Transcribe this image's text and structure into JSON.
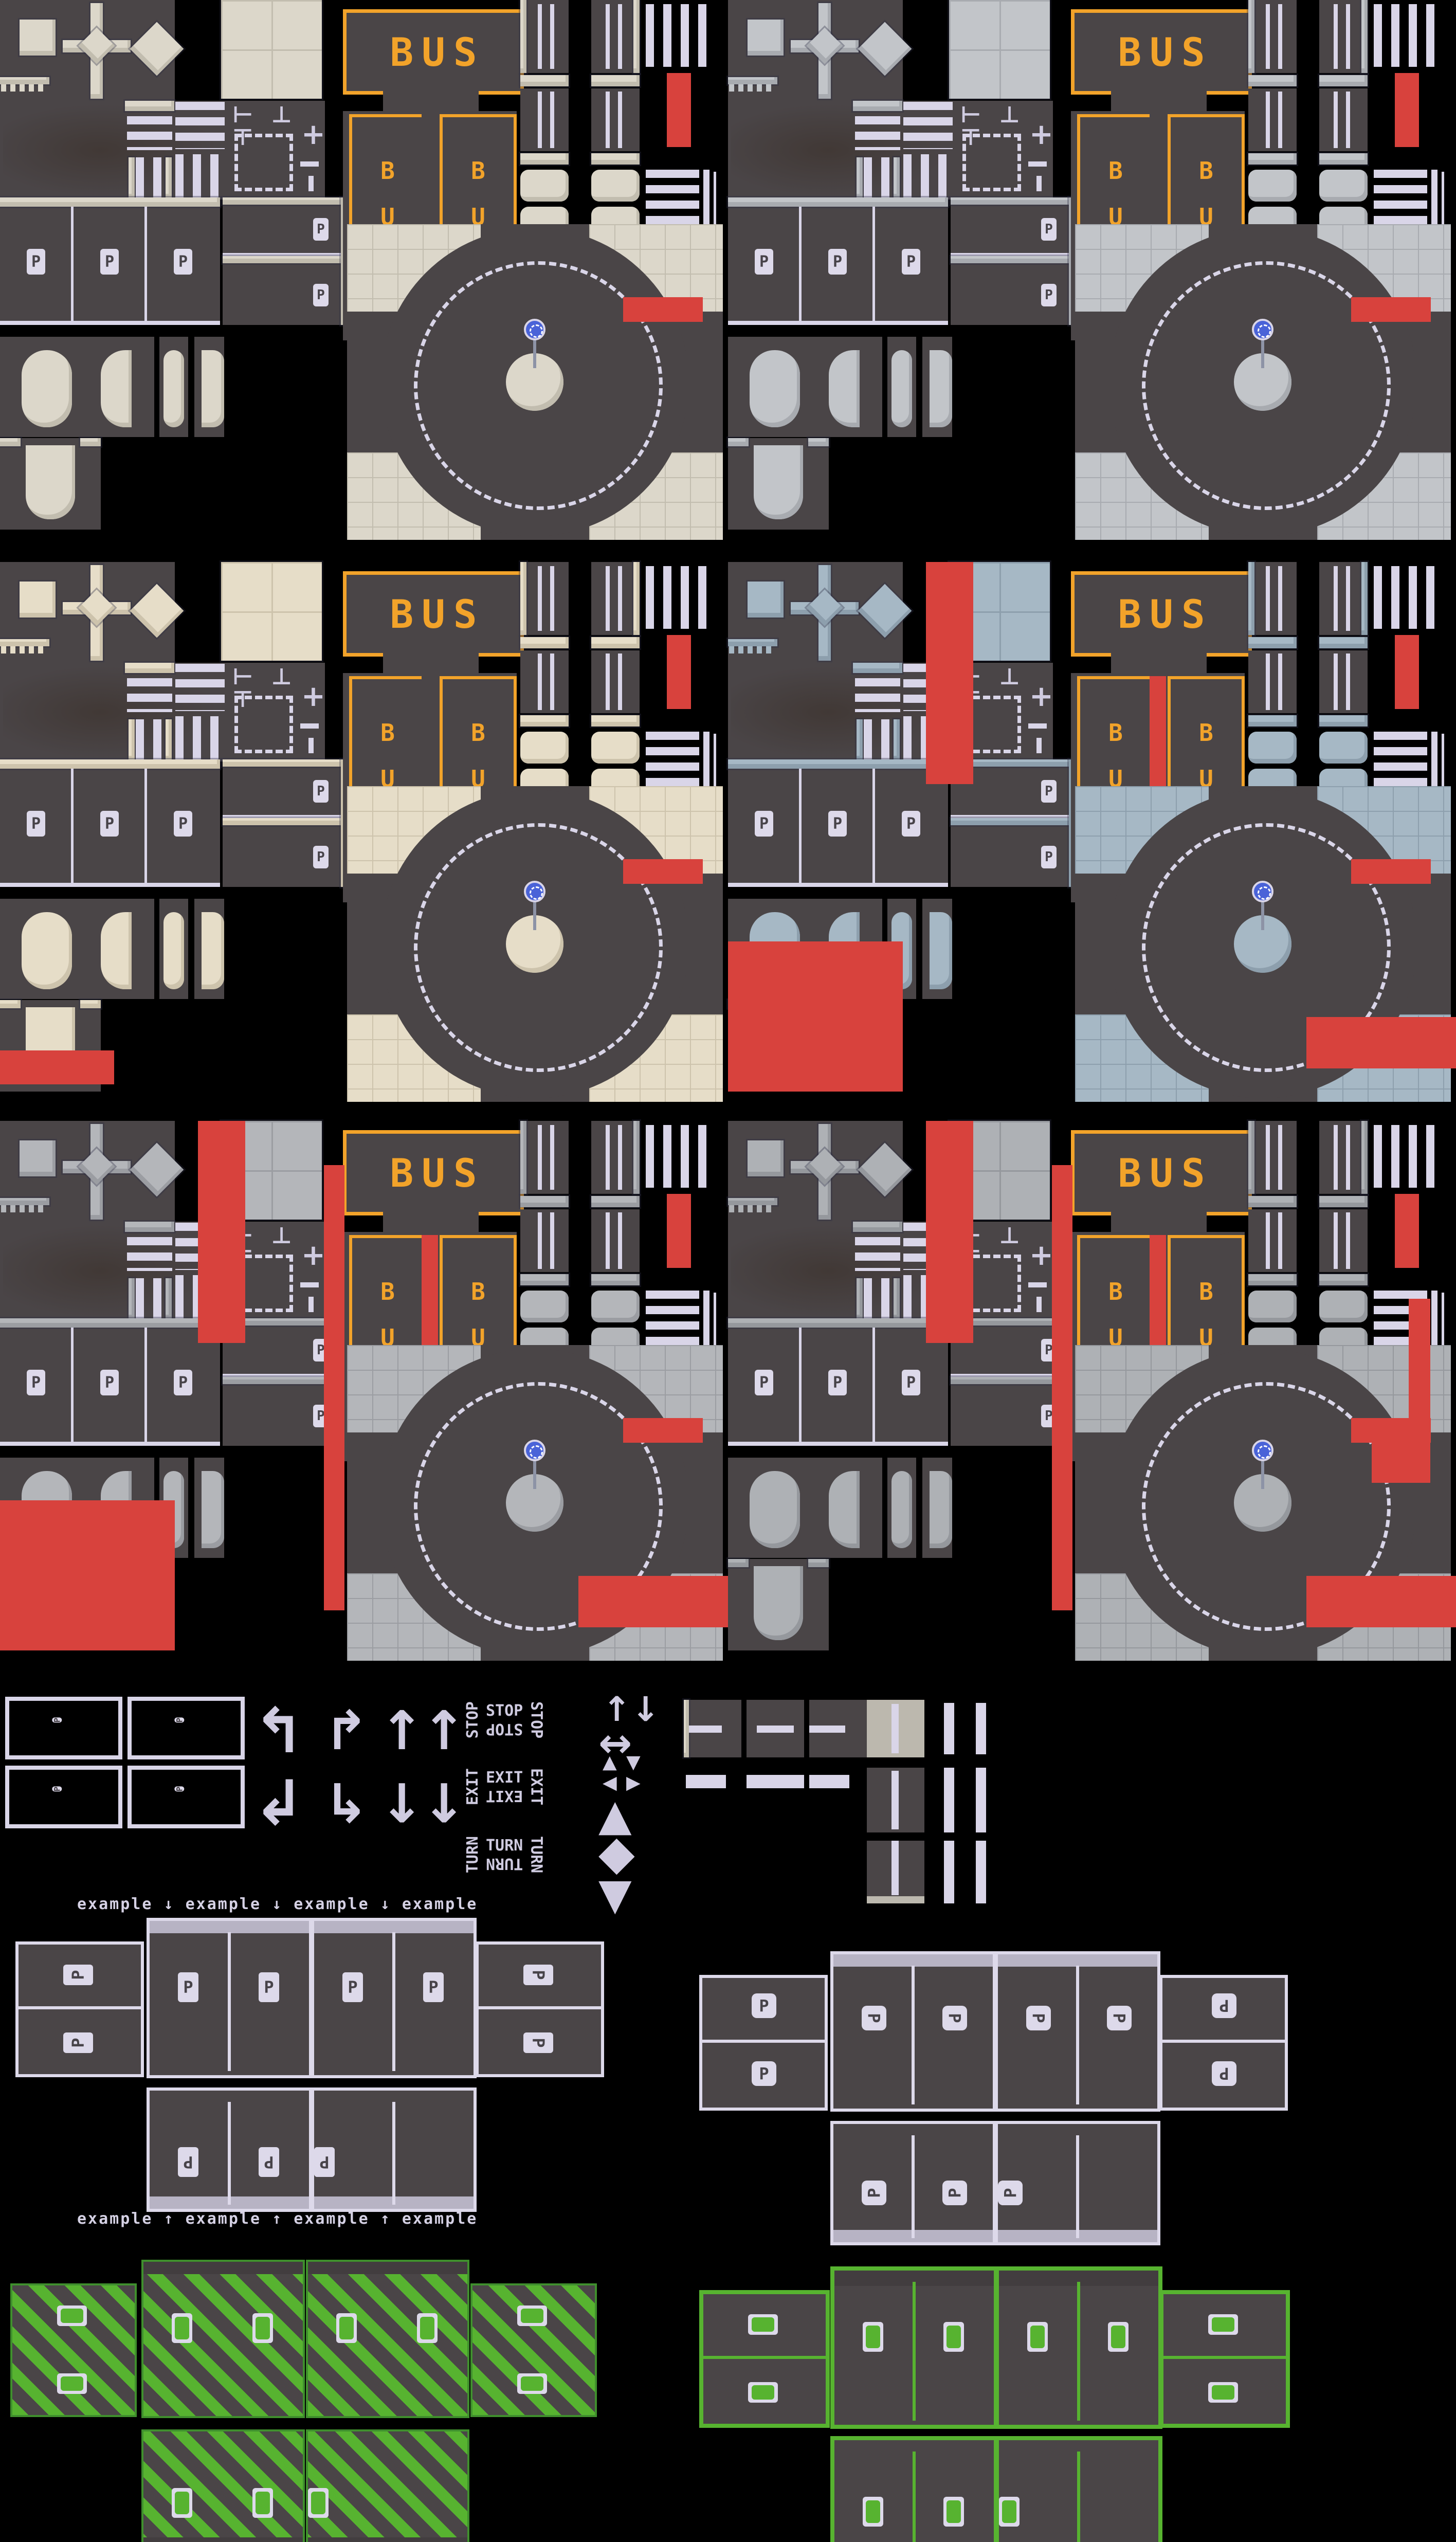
{
  "labels": {
    "bus": "BUS",
    "p": "P",
    "stop": "STOP",
    "exit": "EXIT",
    "turn": "TURN"
  },
  "headings": {
    "top": "example ↓ example ↓ example ↓ example",
    "bottom": "example ↑ example ↑ example ↑ example"
  },
  "icons": {
    "plus": "+",
    "junction_marks": "⊢ ⊥ ⊤",
    "arrow_up": "↑",
    "arrow_down": "↓",
    "arrow_left_up_hook": "↰",
    "arrow_left_down_hook": "↲",
    "arrow_right_up_hook": "↱",
    "arrow_right_down_hook": "↳",
    "arrow_double_horizontal": "↔",
    "triangle_up": "▲",
    "triangle_down": "▼",
    "triangle_left": "◀",
    "triangle_right": "▶",
    "diamond": "◆"
  },
  "colors": {
    "background": "#000000",
    "asphalt": "#4a4547",
    "asphalt_dark": "#423d3f",
    "line": "#d9d5e8",
    "orange": "#f2a32a",
    "red": "#d8423d",
    "green": "#57b330",
    "green_dark": "#3f8f2d",
    "sign_blue": "#4a63d8",
    "plaque": "#ddd9ea"
  },
  "blocks": [
    {
      "id": "v1",
      "sidewalk": "#dcd7ca",
      "sidewalk_shade": "#c2bdaf"
    },
    {
      "id": "v2",
      "sidewalk": "#c2c5c9",
      "sidewalk_shade": "#a8abb0"
    },
    {
      "id": "v3",
      "sidewalk": "#e6ddc8",
      "sidewalk_shade": "#cdc3ac"
    },
    {
      "id": "v4",
      "sidewalk": "#a6b8c5",
      "sidewalk_shade": "#8d9fad"
    },
    {
      "id": "v5",
      "sidewalk": "#b4b6ba",
      "sidewalk_shade": "#9b9da2"
    },
    {
      "id": "v6",
      "sidewalk": "#aeb1b5",
      "sidewalk_shade": "#95989d"
    }
  ],
  "parking_groups": [
    {
      "id": "gv-p-rect",
      "sign": "p"
    },
    {
      "id": "gv-p-sq",
      "sign": "p"
    },
    {
      "id": "gv-ev-striped",
      "sign": "ev"
    },
    {
      "id": "gv-ev-plain",
      "sign": "ev"
    }
  ]
}
